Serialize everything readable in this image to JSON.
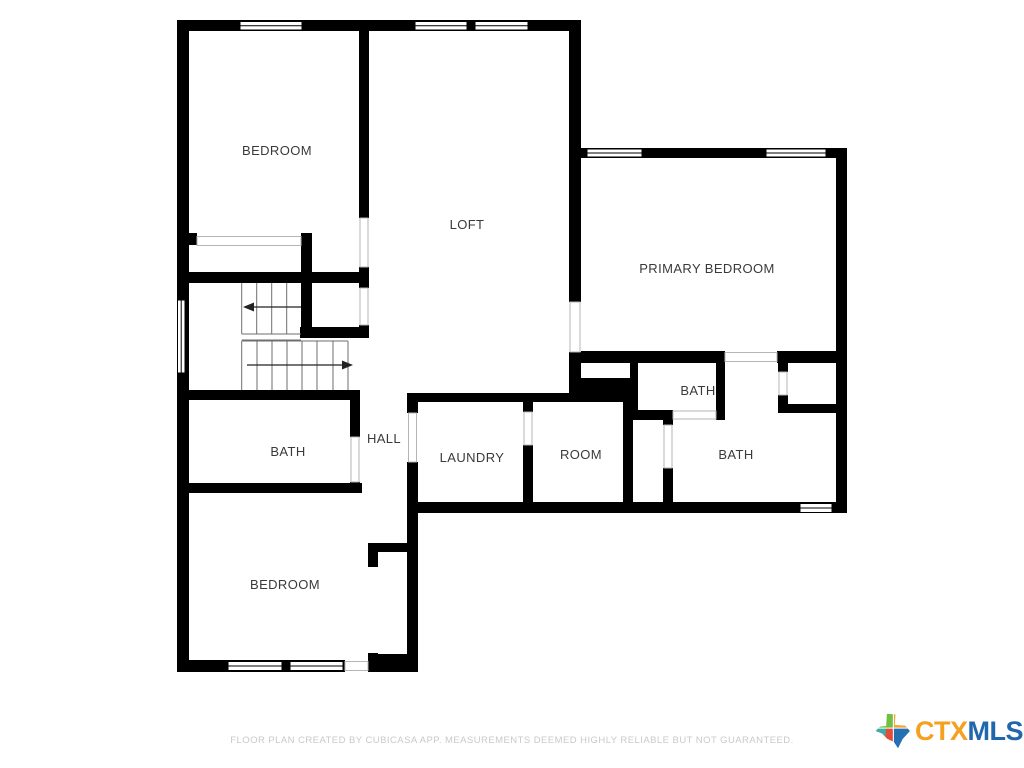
{
  "rooms": [
    {
      "id": "bedroom-top-left",
      "label": "BEDROOM"
    },
    {
      "id": "loft",
      "label": "LOFT"
    },
    {
      "id": "primary-bedroom",
      "label": "PRIMARY BEDROOM"
    },
    {
      "id": "bath-small-primary",
      "label": "BATH"
    },
    {
      "id": "bath-primary",
      "label": "BATH"
    },
    {
      "id": "room",
      "label": "ROOM"
    },
    {
      "id": "laundry",
      "label": "LAUNDRY"
    },
    {
      "id": "hall",
      "label": "HALL"
    },
    {
      "id": "bath-left",
      "label": "BATH"
    },
    {
      "id": "bedroom-bottom-left",
      "label": "BEDROOM"
    }
  ],
  "footer": {
    "disclaimer": "FLOOR PLAN CREATED BY CUBICASA APP. MEASUREMENTS DEEMED HIGHLY RELIABLE BUT NOT GUARANTEED."
  },
  "logo": {
    "ctx": "CTX",
    "mls": "MLS",
    "ctx_color": "#f5a01e",
    "mls_color": "#2167ae",
    "icon": "texas-state-icon"
  },
  "icons": {
    "stair_up_arrow": "stair-arrow-left-icon",
    "stair_down_arrow": "stair-arrow-right-icon"
  },
  "colors": {
    "wall": "#000000",
    "background": "#ffffff",
    "label_text": "#3a3a3a",
    "footer_text": "#c9c9c9"
  }
}
